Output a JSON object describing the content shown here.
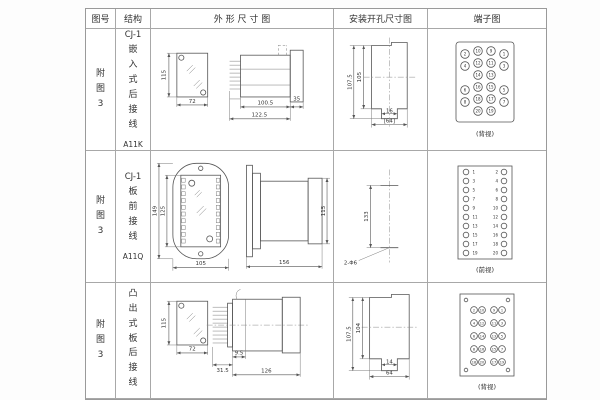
{
  "header": {
    "col_fig": "图号",
    "col_struct": "结构",
    "col_outline": "外 形 尺 寸 图",
    "col_mount": "安装开孔尺寸图",
    "col_terminal": "端子图"
  },
  "rows": [
    {
      "fig": "附图3",
      "struct_model": "CJ-1",
      "struct_desc": "嵌入式后接线",
      "struct_code": "A11K",
      "outline": {
        "front_h": "115",
        "front_w": "72",
        "side_w1": "100.5",
        "side_w2": "122.5",
        "side_w3": "35"
      },
      "mount": {
        "h_outer": "107.5",
        "h_inner": "105",
        "w_inner": "16",
        "w_outer": "[64]"
      },
      "terminal": {
        "caption": "(背视)",
        "rows": [
          [
            "2",
            "10",
            "9",
            "1"
          ],
          [
            "4",
            "12",
            "11",
            "3"
          ],
          [
            "",
            "14",
            "13",
            ""
          ],
          [
            "6",
            "16",
            "15",
            "5"
          ],
          [
            "8",
            "18",
            "17",
            "7"
          ],
          [
            "",
            "20",
            "19",
            ""
          ]
        ]
      }
    },
    {
      "fig": "附图3",
      "struct_model": "CJ-1",
      "struct_desc": "板前接线",
      "struct_code": "A11Q",
      "outline": {
        "front_h1": "149",
        "front_h2": "125",
        "front_w": "105",
        "side_w": "156",
        "side_h": "115"
      },
      "mount": {
        "h": "133",
        "hole_label": "2-Φ6"
      },
      "terminal": {
        "caption": "(前视)",
        "left": [
          "1",
          "3",
          "5",
          "7",
          "9",
          "11",
          "13",
          "15",
          "17",
          "19"
        ],
        "right": [
          "2",
          "4",
          "6",
          "8",
          "10",
          "12",
          "14",
          "16",
          "18",
          "20"
        ]
      }
    },
    {
      "fig": "附图3",
      "struct_model": "CJ-1",
      "struct_desc": "凸出式板后接线",
      "struct_code": "A11H",
      "outline": {
        "front_h": "115",
        "front_w": "72",
        "side_w1": "31.5",
        "side_w2": "9.5",
        "side_w3": "126"
      },
      "mount": {
        "h_outer": "107.5",
        "h_inner": "104",
        "w_inner": "14",
        "w_outer": "64"
      },
      "terminal": {
        "caption": "(背视)",
        "left": [
          [
            "2",
            "10"
          ],
          [
            "4",
            "12"
          ],
          [
            "6",
            "14"
          ],
          [
            "8",
            "16"
          ],
          [
            "18",
            "20"
          ]
        ],
        "right": [
          [
            "9",
            "1"
          ],
          [
            "11",
            "3"
          ],
          [
            "13",
            "5"
          ],
          [
            "15",
            "7"
          ],
          [
            "17",
            "19"
          ]
        ]
      }
    }
  ]
}
